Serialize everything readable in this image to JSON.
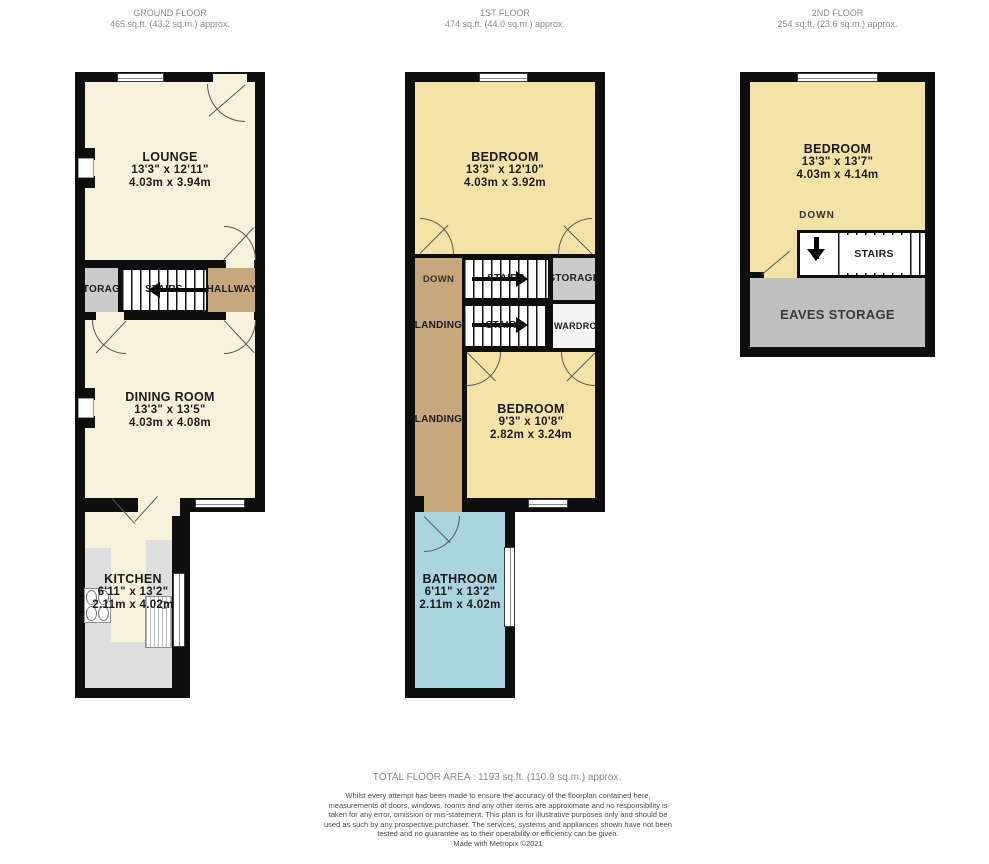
{
  "colors": {
    "wall": "#0e0e0e",
    "cream": "#f8f1db",
    "yellow": "#f5e2a6",
    "tan": "#c7a77c",
    "storage-gray": "#cbcbcb",
    "eaves-gray": "#bfbfbf",
    "bath-blue": "#aad4e0",
    "counter-gray": "#dedede"
  },
  "floors": {
    "ground": {
      "title": "GROUND FLOOR",
      "area": "465 sq.ft. (43.2 sq.m.) approx.",
      "lounge": {
        "name": "LOUNGE",
        "imperial": "13'3\"  x 12'11\"",
        "metric": "4.03m  x 3.94m"
      },
      "storage": "STORAGE",
      "stairs": "STAIRS",
      "hallway": "HALLWAY",
      "dining": {
        "name": "DINING ROOM",
        "imperial": "13'3\"  x 13'5\"",
        "metric": "4.03m  x 4.08m"
      },
      "kitchen": {
        "name": "KITCHEN",
        "imperial": "6'11\"  x 13'2\"",
        "metric": "2.11m  x 4.02m"
      }
    },
    "first": {
      "title": "1ST FLOOR",
      "area": "474 sq.ft. (44.0 sq.m.) approx.",
      "bedroom1": {
        "name": "BEDROOM",
        "imperial": "13'3\"  x 12'10\"",
        "metric": "4.03m  x 3.92m"
      },
      "down": "DOWN",
      "stairs_upper": "STAIRS",
      "storage": "STORAGE",
      "landing_upper": "LANDING",
      "stairs_lower": "STAIRS",
      "wardrobe": "WARDROBE",
      "landing": "LANDING",
      "bedroom2": {
        "name": "BEDROOM",
        "imperial": "9'3\"  x 10'8\"",
        "metric": "2.82m  x 3.24m"
      },
      "bathroom": {
        "name": "BATHROOM",
        "imperial": "6'11\"  x 13'2\"",
        "metric": "2.11m  x 4.02m"
      }
    },
    "second": {
      "title": "2ND FLOOR",
      "area": "254 sq.ft. (23.6 sq.m.) approx.",
      "bedroom": {
        "name": "BEDROOM",
        "imperial": "13'3\"  x 13'7\"",
        "metric": "4.03m  x 4.14m"
      },
      "down": "DOWN",
      "stairs": "STAIRS",
      "eaves": "EAVES STORAGE"
    }
  },
  "footer": {
    "total": "TOTAL FLOOR AREA : 1193 sq.ft. (110.9 sq.m.) approx.",
    "disclaimer": "Whilst every attempt has been made to ensure the accuracy of the floorplan contained here, measurements of doors, windows, rooms and any other items are approximate and no responsibility is taken for any error, omission or mis-statement. This plan is for illustrative purposes only and should be used as such by any prospective purchaser. The services, systems and appliances shown have not been tested and no guarantee as to their operability or efficiency can be given.",
    "credit": "Made with Metropix ©2021"
  }
}
